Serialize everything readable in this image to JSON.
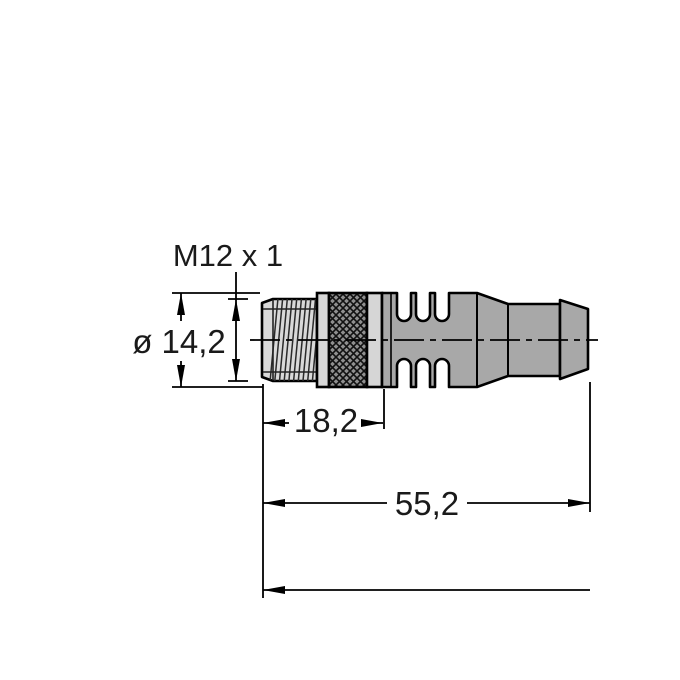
{
  "drawing": {
    "thread_label": "M12 x 1",
    "dimensions": {
      "diameter_label": "ø 14,2",
      "thread_length_label": "18,2",
      "body_length_label": "55,2"
    },
    "colors": {
      "outline": "#000000",
      "dimension_lines": "#000000",
      "molded_body_gray": "#a8a8a8",
      "thread_fill": "#d9d9d9",
      "nut_ring_fill": "#d6d6d6",
      "knurl_fill": "#8f8f8f",
      "background": "#ffffff"
    }
  }
}
